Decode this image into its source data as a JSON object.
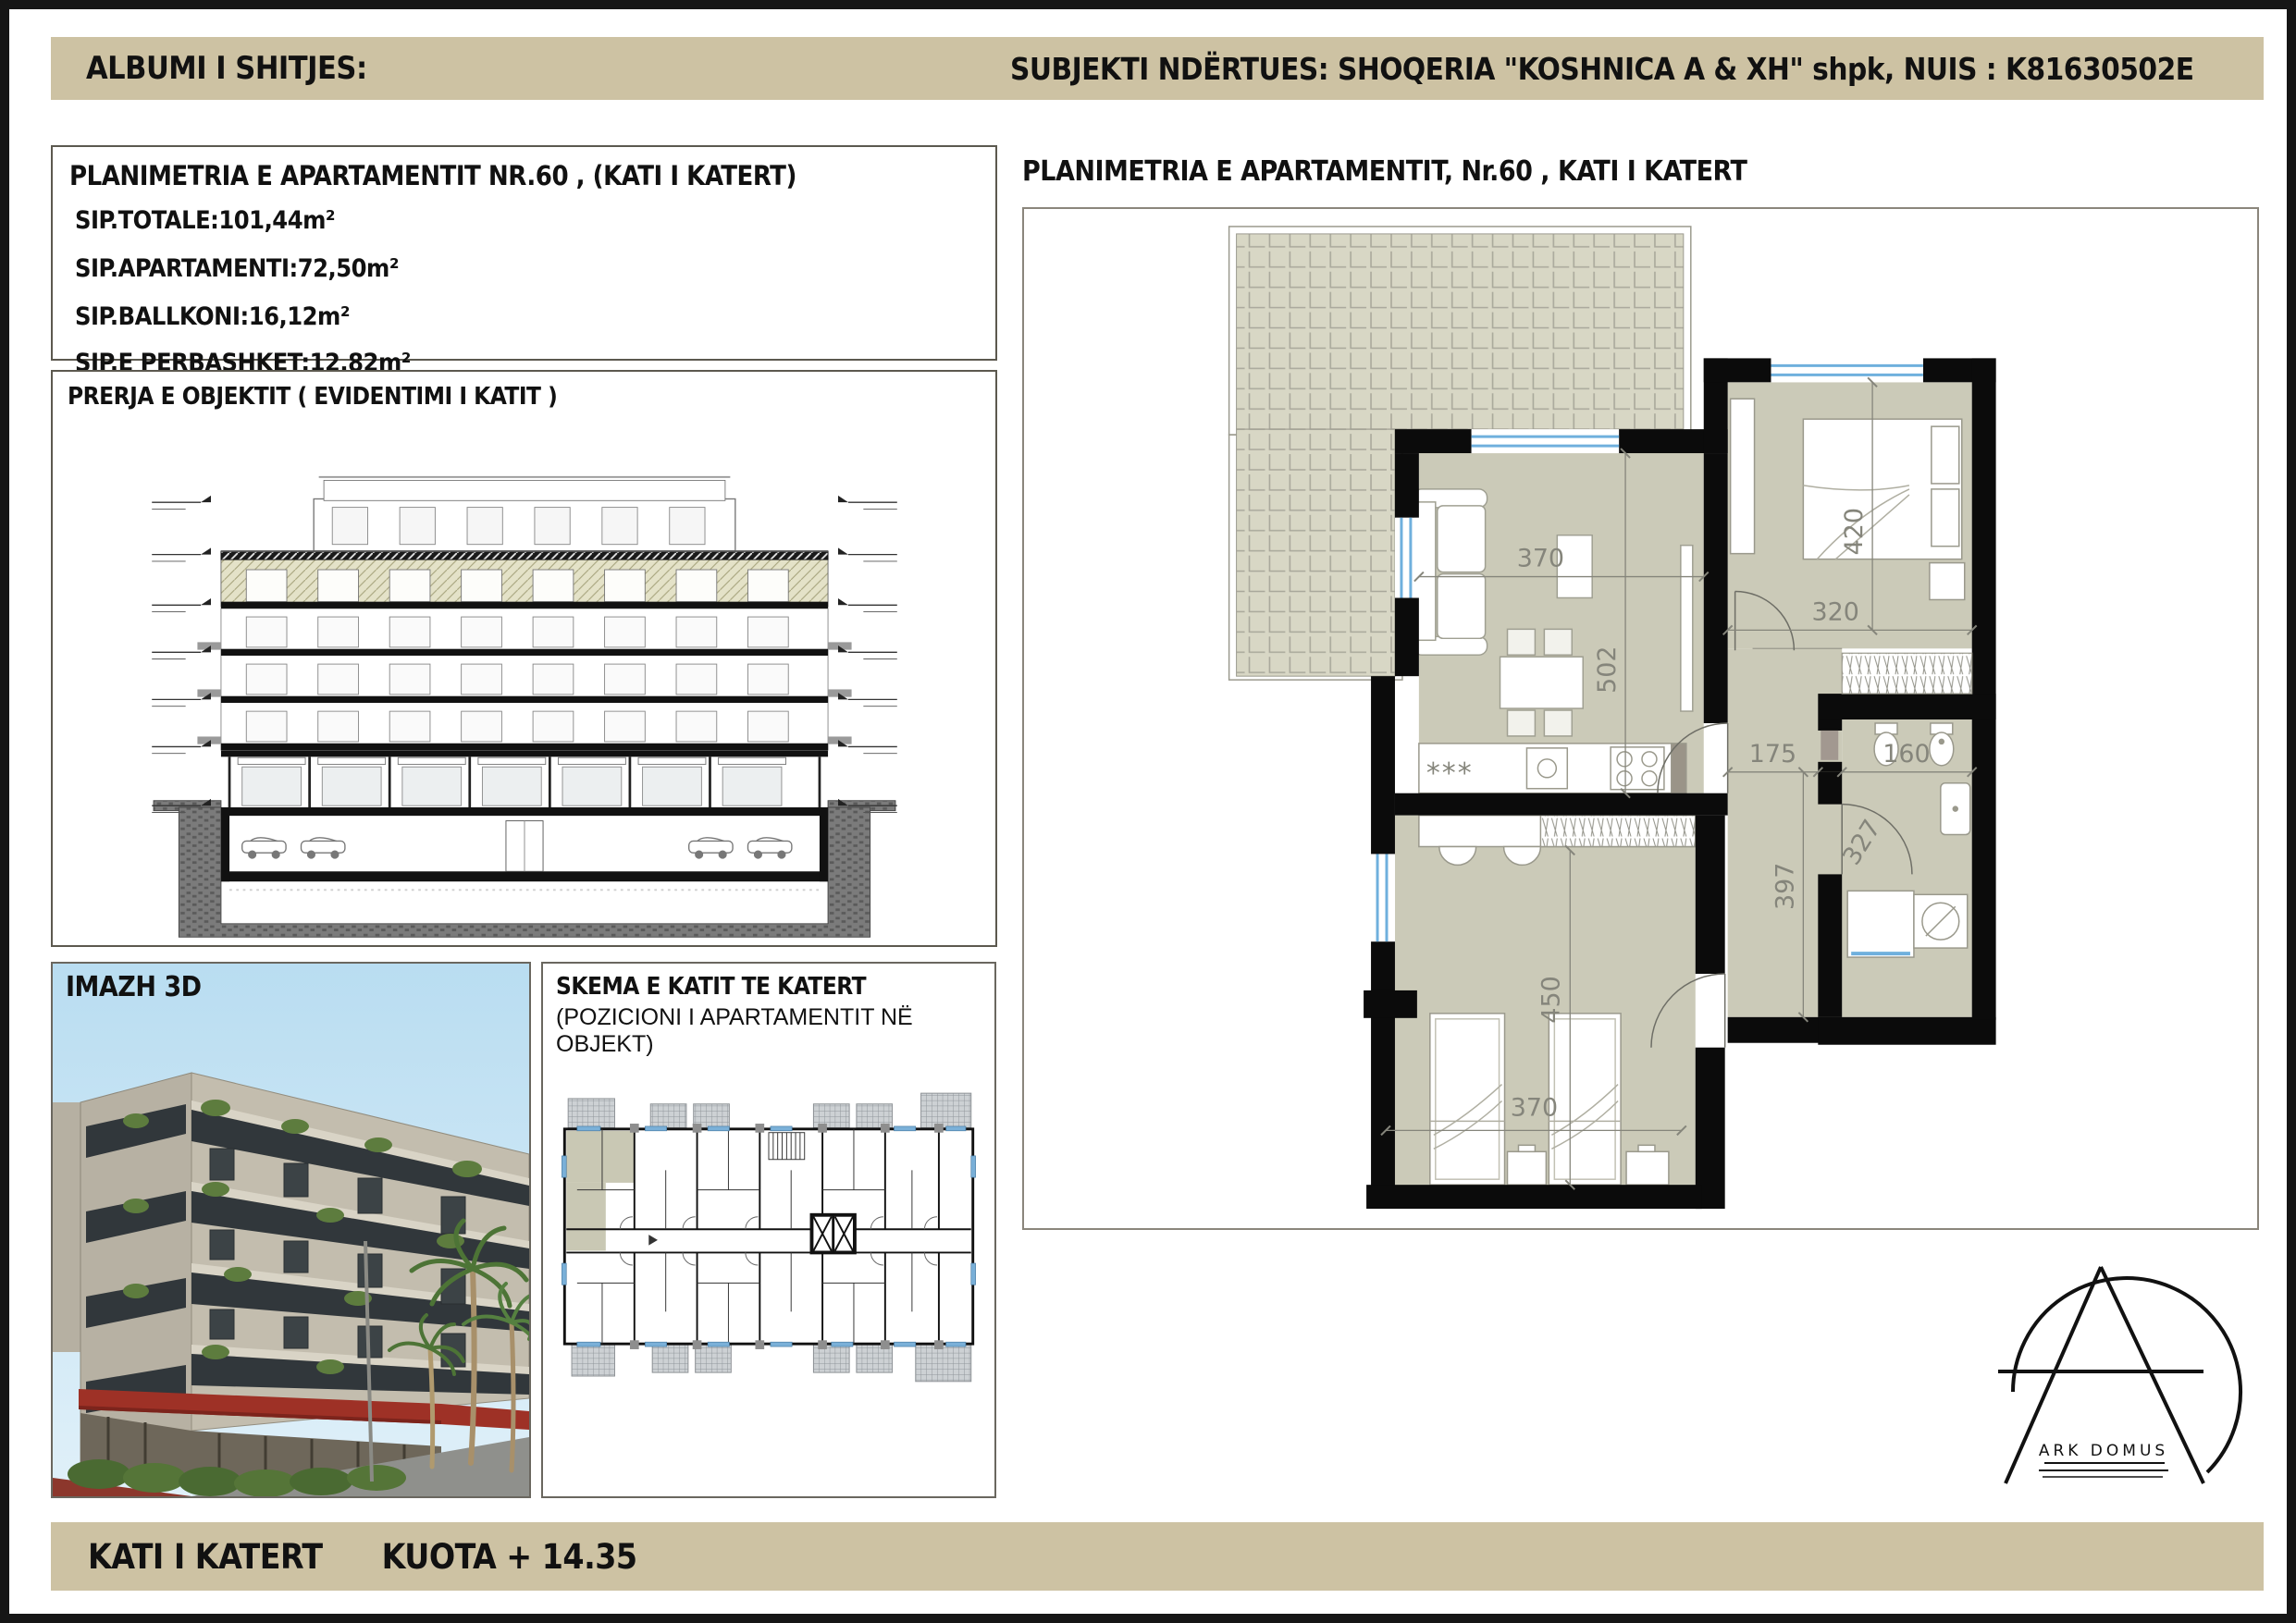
{
  "header": {
    "left": "ALBUMI I SHITJES:",
    "right": "SUBJEKTI NDËRTUES:  SHOQERIA \"KOSHNICA A & XH\" shpk, NUIS : K81630502E"
  },
  "info_box": {
    "title": "PLANIMETRIA E APARTAMENTIT NR.60 , (KATI I KATERT)",
    "rows": [
      "SIP.TOTALE:101,44m²",
      "SIP.APARTAMENTI:72,50m²",
      "SIP.BALLKONI:16,12m²",
      "SIP.E PERBASHKET:12,82m²"
    ]
  },
  "section_box": {
    "title": "PRERJA E OBJEKTIT ( EVIDENTIMI I KATIT )"
  },
  "image_box": {
    "label": "IMAZH 3D"
  },
  "schema_box": {
    "title": "SKEMA E KATIT TE KATERT",
    "subtitle": "(POZICIONI I APARTAMENTIT NË OBJEKT)"
  },
  "plan": {
    "title": "PLANIMETRIA E APARTAMENTIT, Nr.60 , KATI I KATERT",
    "kitchen_label": "***",
    "dims": {
      "living_width": "370",
      "living_depth": "502",
      "bedroom1_depth": "420",
      "bedroom1_width": "320",
      "hall_width": "175",
      "wc_width": "160",
      "hall_depth": "397",
      "bath_door": "327",
      "bedroom2_depth": "450",
      "bedroom2_width": "370"
    }
  },
  "logo": {
    "name": "ARK DOMUS"
  },
  "footer": {
    "floor_label": "KATI I KATERT",
    "elevation_label": "KUOTA + 14.35"
  },
  "colors": {
    "band_tan": "#cdc2a3",
    "floor_olive": "#cbcab8",
    "terrace_tile": "#d8d7c5",
    "wall_black": "#0b0b0b",
    "window_blue": "#6fb0dd",
    "highlight_unit": "#c9c8b4"
  }
}
